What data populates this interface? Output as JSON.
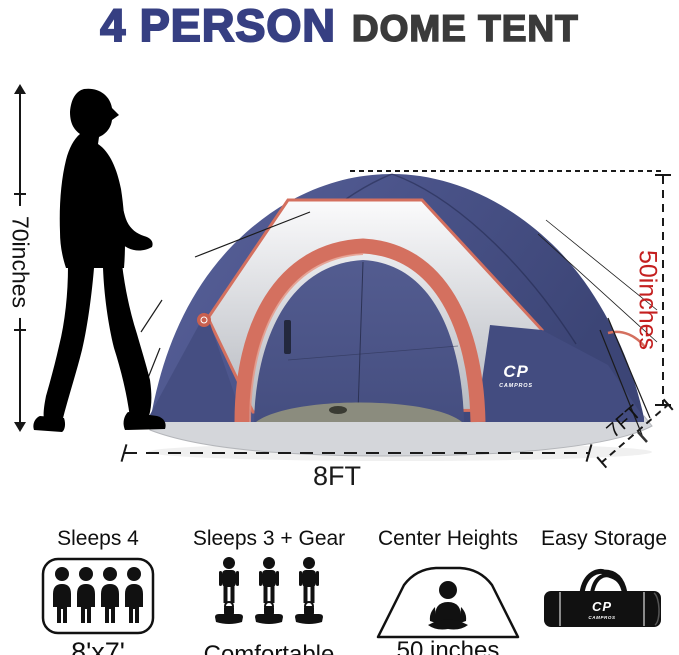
{
  "title": {
    "highlight": "4 PERSON",
    "rest": "DOME TENT"
  },
  "dimensions": {
    "person_height": "70inches",
    "tent_center_height": "50inches",
    "tent_width": "8FT",
    "tent_depth": "7FT"
  },
  "brand": {
    "logo": "CP",
    "name": "CAMPROS"
  },
  "features": [
    {
      "label": "Sleeps 4",
      "sublabel": "8'x7'"
    },
    {
      "label": "Sleeps 3 + Gear",
      "sublabel": "Comfortable"
    },
    {
      "label": "Center Heights",
      "sublabel": "50 inches"
    },
    {
      "label": "Easy Storage",
      "sublabel": ""
    }
  ],
  "colors": {
    "title_blue": "#363f82",
    "title_dark": "#3a3a3a",
    "dimension_red": "#c41f1f",
    "tent_navy": "#4a5389",
    "tent_coral": "#d4705f",
    "tent_gray_panel": "#c9ccd1",
    "tent_skirt_gray": "#d4d6da",
    "icon_black": "#111111"
  }
}
